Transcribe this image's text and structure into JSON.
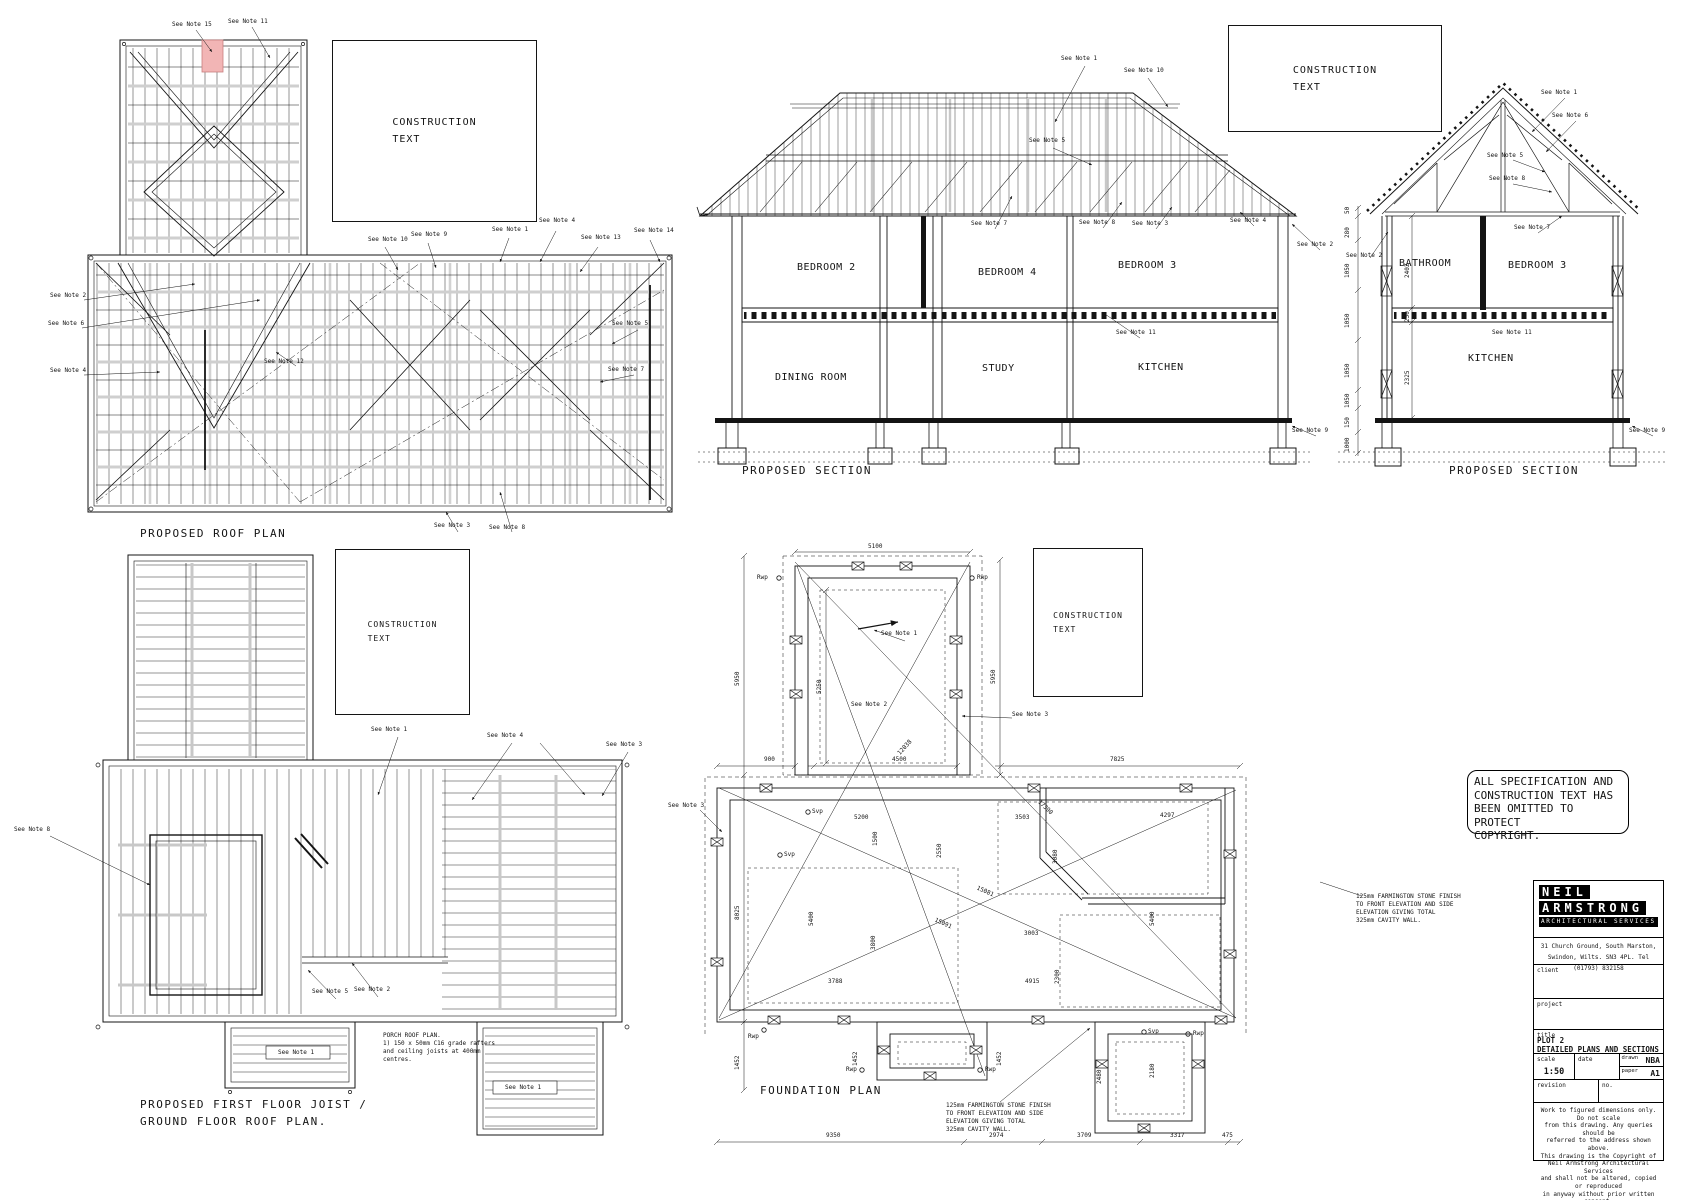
{
  "construction_text": "CONSTRUCTION\nTEXT",
  "notes": {
    "1": "See Note 1",
    "2": "See Note 2",
    "3": "See Note 3",
    "4": "See Note 4",
    "5": "See Note 5",
    "6": "See Note 6",
    "7": "See Note 7",
    "8": "See Note 8",
    "9": "See Note 9",
    "10": "See Note 10",
    "11": "See Note 11",
    "12": "See Note 12",
    "13": "See Note 13",
    "14": "See Note 14",
    "15": "See Note 15"
  },
  "roof_plan": {
    "title": "PROPOSED ROOF PLAN"
  },
  "section_a": {
    "title": "PROPOSED SECTION",
    "rooms": {
      "bedroom2": "BEDROOM 2",
      "bedroom4": "BEDROOM 4",
      "bedroom3": "BEDROOM 3",
      "dining": "DINING ROOM",
      "study": "STUDY",
      "kitchen": "KITCHEN"
    }
  },
  "section_b": {
    "title": "PROPOSED SECTION",
    "rooms": {
      "bathroom": "BATHROOM",
      "bedroom3": "BEDROOM 3",
      "kitchen": "KITCHEN"
    },
    "outer_dims": [
      "50",
      "280",
      "1050",
      "1050",
      "1050",
      "1050",
      "150",
      "1000"
    ],
    "inner_dims": [
      "2402",
      "250",
      "2325"
    ]
  },
  "joist_plan": {
    "title_line1": "PROPOSED FIRST FLOOR JOIST /",
    "title_line2": "GROUND FLOOR ROOF PLAN.",
    "porch_note": "PORCH ROOF PLAN.\n1)  150 x 50mm C16 grade rafters\nand ceiling joists at 400mm\ncentres."
  },
  "foundation_plan": {
    "title": "FOUNDATION PLAN",
    "stone_note": "125mm FARMINGTON STONE FINISH\nTO FRONT ELEVATION AND SIDE\nELEVATION GIVING TOTAL\n325mm CAVITY WALL.",
    "labels": {
      "rwp": "Rwp",
      "svp": "Svp"
    },
    "dims": {
      "d5100": "5100",
      "d5950a": "5950",
      "d5950b": "5950",
      "d5250": "5250",
      "d900": "900",
      "d4500": "4500",
      "d7825": "7825",
      "d8025": "8025",
      "d1452a": "1452",
      "d1452b": "1452",
      "d1452c": "1452",
      "d5200": "5200",
      "d1500": "1500",
      "d3503": "3503",
      "d4297": "4297",
      "d2550": "2550",
      "d3080": "3080",
      "d5400a": "5400",
      "d3800": "3800",
      "d3788": "3788",
      "d4915": "4915",
      "d2300": "2300",
      "d3003": "3003",
      "d5400b": "5400",
      "d2480": "2480",
      "d2180": "2180",
      "d9350": "9350",
      "d2974": "2974",
      "d3709": "3709",
      "d3317": "3317",
      "d475": "475",
      "g12038": "12038",
      "g17390": "17390",
      "g15081": "15081",
      "g15091": "15091"
    }
  },
  "copyright_notice": "ALL SPECIFICATION AND\nCONSTRUCTION TEXT HAS\nBEEN OMITTED TO PROTECT\nCOPYRIGHT.",
  "title_block": {
    "logo_line1": "NEIL",
    "logo_line2": "ARMSTRONG",
    "logo_line3": "ARCHITECTURAL SERVICES",
    "address_line1": "31 Church Ground, South Marston,",
    "address_line2": "Swindon, Wilts. SN3 4PL. Tel (01793) 832158",
    "client_label": "client",
    "project_label": "project",
    "title_label": "title",
    "title_value": "PLOT 2\nDETAILED PLANS AND SECTIONS",
    "scale_label": "scale",
    "scale_value": "1:50",
    "date_label": "date",
    "drawn_label": "drawn",
    "drawn_value": "NBA",
    "paper_label": "paper",
    "paper_value": "A1",
    "revision_label": "revision",
    "no_label": "no.",
    "disclaimer": "Work to figured dimensions only. Do not scale\nfrom this drawing. Any queries should be\nreferred to the address shown above.\nThis drawing is the Copyright of\nNeil Armstrong Architectural Services\nand shall not be altered, copied or reproduced\nin anyway without prior written consent."
  },
  "colors": {
    "highlight_pink": "#f2b5b5",
    "line": "#141414",
    "gray_member": "#c8c8c8"
  }
}
